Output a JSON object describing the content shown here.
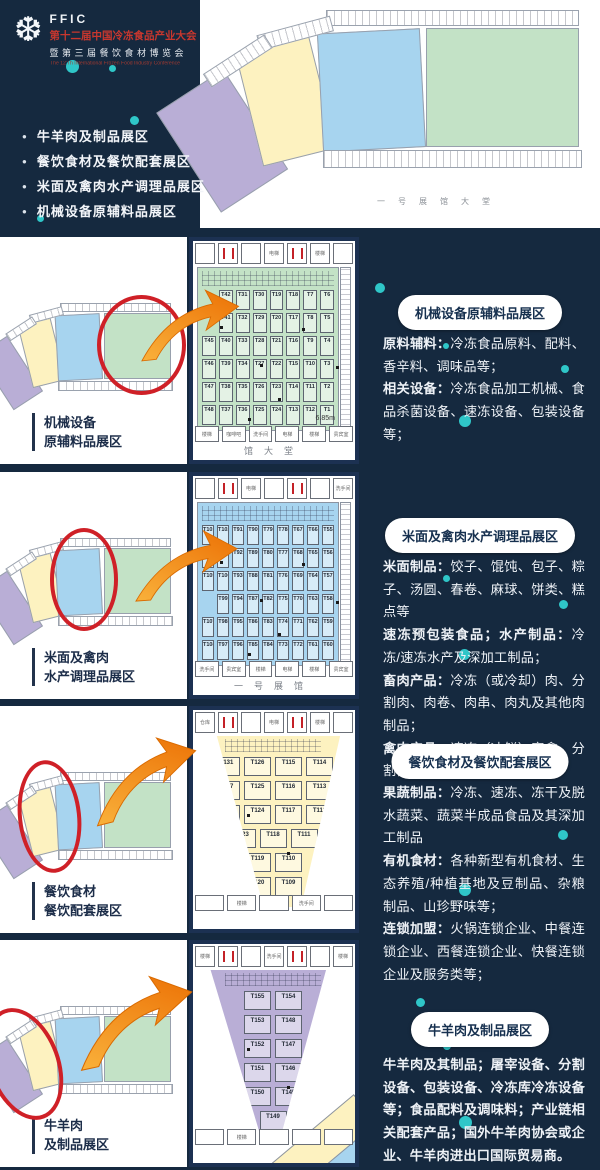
{
  "theme": {
    "background": "#15293f",
    "panel_border": "#1c3152",
    "accent_dot": "#2fc6c8",
    "highlight_red": "#cf2027",
    "arrow_orange": "#ec7004",
    "arrow_orange_light": "#f9b13b",
    "title_red": "#c8372e",
    "zone_colors": {
      "purple": "#b9aed6",
      "yellow": "#fdf2c0",
      "blue": "#a7d4ef",
      "green": "#c3e2c6"
    }
  },
  "header": {
    "logo_abbr": "FFIC",
    "logo_icon": "snowflake-icon",
    "title": "第十二届中国冷冻食品产业大会",
    "subtitle": "暨第三届餐饮食材博览会",
    "subtitle_en": "The 12'Th International Frozen Food Industry Conference",
    "bullets": [
      "牛羊肉及制品展区",
      "餐饮食材及餐饮配套展区",
      "米面及禽肉水产调理品展区",
      "机械设备原辅料品展区"
    ]
  },
  "overview_plan": {
    "corridor_text": "一号展馆大堂",
    "zones": [
      {
        "name": "牛羊肉及制品展区",
        "color_key": "purple"
      },
      {
        "name": "餐饮食材及餐饮配套展区",
        "color_key": "yellow"
      },
      {
        "name": "米面及禽肉水产调理品展区",
        "color_key": "blue"
      },
      {
        "name": "机械设备原辅料品展区",
        "color_key": "green"
      }
    ]
  },
  "sections": [
    {
      "key": "machinery",
      "zone": "green",
      "plan_label_lines": [
        "机械设备",
        "原辅料品展区"
      ],
      "badge": "机械设备原辅料品展区",
      "paragraphs": [
        [
          {
            "bold": true,
            "text": "原料辅料："
          },
          {
            "bold": false,
            "text": "冷冻食品原料、配料、香辛料、调味品等；"
          }
        ],
        [
          {
            "bold": true,
            "text": "相关设备："
          },
          {
            "bold": false,
            "text": "冷冻食品加工机械、食品杀菌设备、速冻设备、包装设备等；"
          }
        ]
      ],
      "zoom_plan": {
        "shape": "rect",
        "columns": 8,
        "booth_rows": [
          [
            "",
            "T42",
            "T31",
            "T30",
            "T19",
            "T18",
            "T7",
            "T6"
          ],
          [
            "",
            "T41",
            "T32",
            "T29",
            "T20",
            "T17",
            "T8",
            "T5"
          ],
          [
            "T45",
            "T40",
            "T33",
            "T28",
            "T21",
            "T16",
            "T9",
            "T4"
          ],
          [
            "T46",
            "T39",
            "T34",
            "T27",
            "T22",
            "T15",
            "T10",
            "T3"
          ],
          [
            "T47",
            "T38",
            "T35",
            "T26",
            "T23",
            "T14",
            "T11",
            "T2"
          ],
          [
            "T48",
            "T37",
            "T36",
            "T25",
            "T24",
            "T13",
            "T12",
            "T1"
          ]
        ],
        "corridor_rooms_top": [
          "",
          "洗手间",
          "",
          "电梯",
          "",
          "楼梯",
          ""
        ],
        "corridor_rooms_bottom": [
          "楼梯",
          "咖啡吧",
          "洗手间",
          "电梯",
          "楼梯",
          "贵宾室"
        ],
        "bottom_text": "馆大堂",
        "dimension_label": "6.85m"
      }
    },
    {
      "key": "rice-noodle-poultry-aquatic",
      "zone": "blue",
      "plan_label_lines": [
        "米面及禽肉",
        "水产调理品展区"
      ],
      "badge": "米面及禽肉水产调理品展区",
      "paragraphs": [
        [
          {
            "bold": true,
            "text": "米面制品："
          },
          {
            "bold": false,
            "text": "饺子、馄饨、包子、粽子、汤圆、春卷、麻球、饼类、糕点等"
          }
        ],
        [
          {
            "bold": true,
            "text": "速冻预包装食品；"
          },
          {
            "bold": true,
            "text": "水产制品："
          },
          {
            "bold": false,
            "text": "冷冻/速冻水产及深加工制品；"
          }
        ],
        [
          {
            "bold": true,
            "text": "畜肉产品："
          },
          {
            "bold": false,
            "text": "冷冻（或冷却）肉、分割肉、肉卷、肉串、肉丸及其他肉制品；"
          }
        ],
        [
          {
            "bold": true,
            "text": "禽肉产品："
          },
          {
            "bold": false,
            "text": "速冻（冰鲜）家禽、分割禽、家禽肉制品和半成品；"
          }
        ]
      ],
      "zoom_plan": {
        "shape": "rect",
        "columns": 9,
        "booth_rows": [
          [
            "T101",
            "T102",
            "T91",
            "T90",
            "T79",
            "T78",
            "T67",
            "T66",
            "T55"
          ],
          [
            "T103",
            "T104",
            "T92",
            "T89",
            "T80",
            "T77",
            "T68",
            "T65",
            "T56"
          ],
          [
            "T105",
            "T106",
            "T93",
            "T88",
            "T81",
            "T76",
            "T69",
            "T64",
            "T57"
          ],
          [
            "",
            "T99",
            "T94",
            "T87",
            "T82",
            "T75",
            "T70",
            "T63",
            "T58"
          ],
          [
            "T107",
            "T98",
            "T95",
            "T86",
            "T83",
            "T74",
            "T71",
            "T62",
            "T59"
          ],
          [
            "T108",
            "T97",
            "T96",
            "T85",
            "T84",
            "T73",
            "T72",
            "T61",
            "T60"
          ]
        ],
        "corridor_rooms_top": [
          "",
          "洗手间",
          "电梯",
          "",
          "楼梯",
          "",
          "洗手间"
        ],
        "corridor_rooms_bottom": [
          "洗手间",
          "贵宾室",
          "楼梯",
          "电梯",
          "楼梯",
          "贵宾室"
        ],
        "bottom_text": "一号展馆",
        "dimension_label": ""
      }
    },
    {
      "key": "catering-ingredients",
      "zone": "yellow",
      "plan_label_lines": [
        "餐饮食材",
        "餐饮配套展区"
      ],
      "badge": "餐饮食材及餐饮配套展区",
      "paragraphs": [
        [
          {
            "bold": true,
            "text": "果蔬制品："
          },
          {
            "bold": false,
            "text": "冷冻、速冻、冻干及脱水蔬菜、蔬菜半成品食品及其深加工制品"
          }
        ],
        [
          {
            "bold": true,
            "text": "有机食材："
          },
          {
            "bold": false,
            "text": "各种新型有机食材、生态养殖/种植基地及豆制品、杂粮制品、山珍野味等；"
          }
        ],
        [
          {
            "bold": true,
            "text": "连锁加盟："
          },
          {
            "bold": false,
            "text": "火锅连锁企业、中餐连锁企业、西餐连锁企业、快餐连锁企业及服务类等；"
          }
        ]
      ],
      "zoom_plan": {
        "shape": "wedge",
        "clip": "polygon(14% 0%, 93% 0%, 68% 100%, 44% 100%)",
        "booth_rows": [
          [
            "T131",
            "T126",
            "T115",
            "T114"
          ],
          [
            "T127",
            "T125",
            "T116",
            "T113"
          ],
          [
            "T128",
            "T124",
            "T117",
            "T112"
          ],
          [
            "T123",
            "T118",
            "T111"
          ],
          [
            "T119",
            "T110"
          ],
          [
            "T120",
            "T109"
          ]
        ],
        "corridor_rooms_top": [
          "仓库",
          "洗手间",
          "",
          "电梯",
          "",
          "楼梯",
          ""
        ],
        "corridor_rooms_bottom": [
          "",
          "楼梯",
          "",
          "洗手间",
          ""
        ],
        "bottom_text": "",
        "dimension_label": ""
      }
    },
    {
      "key": "beef-mutton",
      "zone": "purple",
      "plan_label_lines": [
        "牛羊肉",
        "及制品展区"
      ],
      "badge": "牛羊肉及制品展区",
      "paragraphs": [
        [
          {
            "bold": true,
            "text": "牛羊肉及其制品；屠宰设备、分割设备、包装设备、冷冻库冷冻设备等；食品配料及调味料；产业链相关配套产品；国外牛羊肉协会或企业、牛羊肉进出口国际贸易商。"
          }
        ]
      ],
      "zoom_plan": {
        "shape": "wedge",
        "clip": "polygon(10% 0%, 84% 0%, 55% 97%, 42% 97%)",
        "booth_rows": [
          [
            "T155",
            "T154"
          ],
          [
            "T153",
            "T148"
          ],
          [
            "T152",
            "T147"
          ],
          [
            "T151",
            "T146"
          ],
          [
            "T150",
            "T145"
          ],
          [
            "T149"
          ]
        ],
        "corridor_rooms_top": [
          "楼梯",
          "电梯",
          "",
          "洗手间",
          "仓库",
          "",
          "楼梯"
        ],
        "corridor_rooms_bottom": [
          "",
          "楼梯",
          "",
          "",
          ""
        ],
        "bottom_text": "",
        "dimension_label": ""
      }
    }
  ]
}
